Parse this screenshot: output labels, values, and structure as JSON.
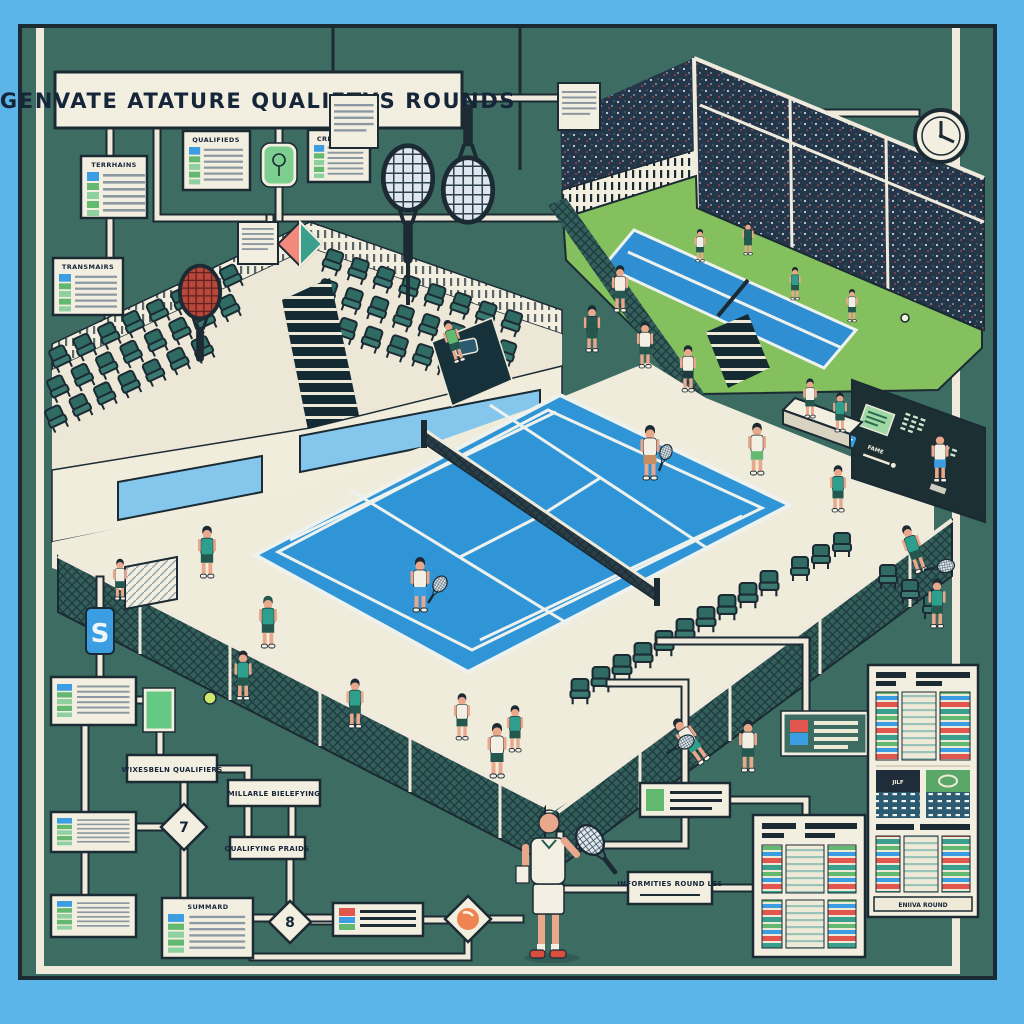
{
  "banner": {
    "text": "GENVATE ATATURE QUALIFTYS ROUNDS"
  },
  "flowchart": {
    "cards": [
      {
        "id": "card-terrains",
        "header": "TERRHAINS"
      },
      {
        "id": "card-qualifieds",
        "header": "QUALIFIEDS"
      },
      {
        "id": "card-creusiers",
        "header": "CREUSIERS"
      },
      {
        "id": "card-transmairs",
        "header": "TRANSMAIRS"
      },
      {
        "id": "card-summard",
        "header": "SUMMARD"
      }
    ],
    "labels": [
      {
        "id": "label-1",
        "text": "WIXESBELN QUALIFIERS"
      },
      {
        "id": "label-2",
        "text": "MILLARLE BIELEFYING"
      },
      {
        "id": "label-3",
        "text": "QUALIFYING PRAIDS"
      },
      {
        "id": "label-4",
        "text": "INFORMITIES ROUND LES"
      }
    ],
    "decisions": [
      {
        "id": "diamond-1",
        "glyph": "7"
      },
      {
        "id": "diamond-2",
        "glyph": "8"
      },
      {
        "id": "diamond-3",
        "glyph": "spiral-ball"
      }
    ],
    "badges": [
      {
        "id": "s-badge",
        "glyph": "S"
      },
      {
        "id": "racket-badge",
        "glyph": "racket"
      }
    ]
  },
  "panels": {
    "bracket_caption": "ENIIVA ROUND",
    "score_card_code": "JILF",
    "scoreboard_label": "FAME"
  },
  "icons": {
    "clock-icon": "clock face, hands at 12 and 3",
    "tennis-racket-icon": "ellipse head with string grid and handle",
    "red-racket-icon": "racket with red strings",
    "s-badge-icon": "blue tag with white S",
    "racket-badge-icon": "green rounded tag with mini racket",
    "document-icon": "cream sheet with gray lines",
    "document-diamond-icon": "sheet with pink/teal diamond tag",
    "decision-ball-icon": "orange ball with white crescent",
    "tennis-ball-icon": "yellow-green ball",
    "accessibility-badge-icon": "small blue plaque with white marks"
  },
  "palette": {
    "frame_blue": "#5cb5e9",
    "outline_navy": "#1b2a33",
    "background_teal": "#3d6c63",
    "cream": "#f3efe0",
    "court_blue": "#3095d6",
    "secondary_court_blue": "#2f8fd2",
    "grass_green": "#85c05e",
    "seat_teal": "#2f6b63",
    "shirt_teal": "#2f9f8d",
    "skin": "#e9a78c",
    "accent_red": "#e2574d",
    "accent_green": "#62b96f",
    "accent_blue": "#3b9ee2",
    "badge_green": "#7ccf8e",
    "crowd_navy": "#243649"
  }
}
